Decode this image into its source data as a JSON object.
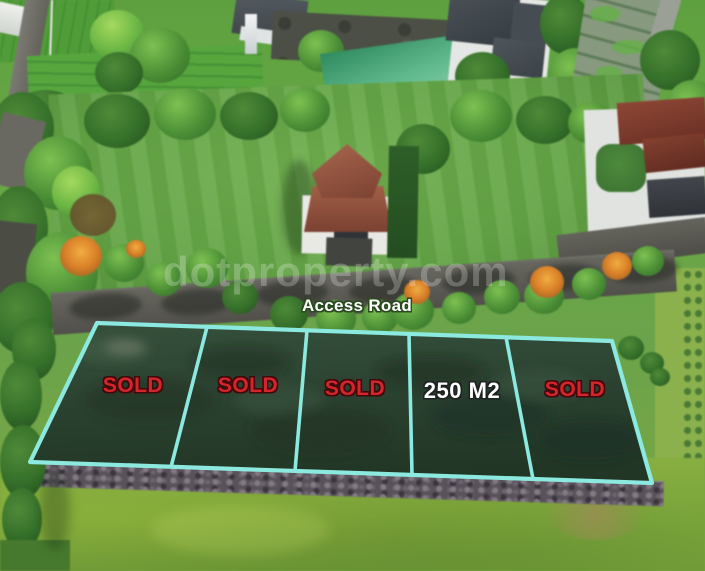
{
  "overlay": {
    "access_road_label": "Access Road",
    "watermark_text": "dotproperty.com",
    "plots": [
      {
        "label": "SOLD",
        "status": "sold"
      },
      {
        "label": "SOLD",
        "status": "sold"
      },
      {
        "label": "SOLD",
        "status": "sold"
      },
      {
        "label": "250 M2",
        "status": "available"
      },
      {
        "label": "SOLD",
        "status": "sold"
      }
    ],
    "colors": {
      "plot_outline": "#8CE9DF",
      "sold_text": "#D2262C",
      "sold_text_outline": "#42090B",
      "available_text": "#FFFFFF",
      "available_text_outline": "#1E2320",
      "access_road_text": "#FFFFFF",
      "access_road_text_outline": "#2A4A20",
      "watermark_color": "rgba(255,255,255,0.24)"
    }
  }
}
